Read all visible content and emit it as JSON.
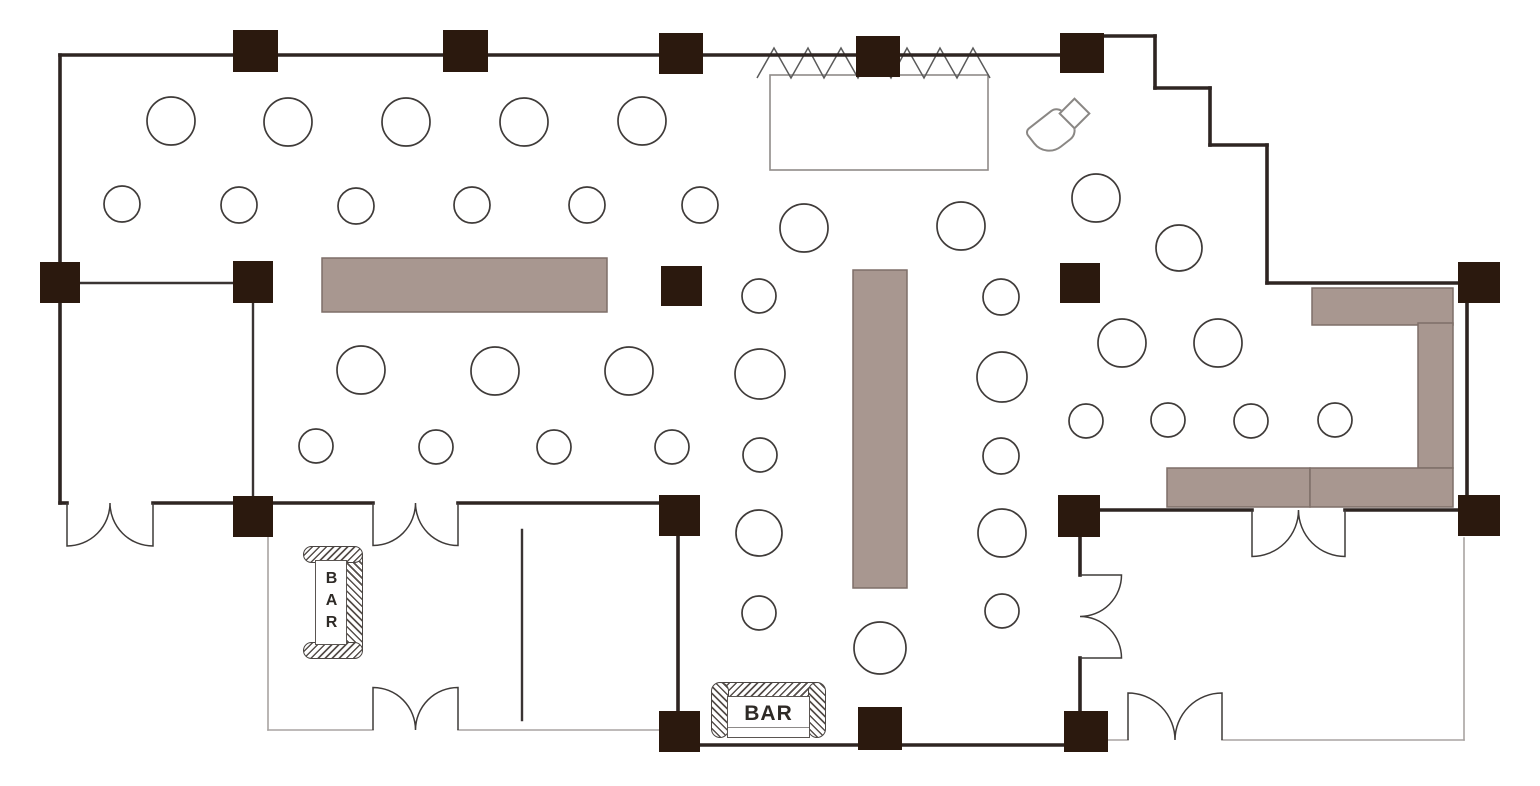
{
  "title": "Banquet hall floor plan",
  "bars": {
    "horizontal": "BAR",
    "vertical": "BAR"
  },
  "plan": {
    "width": 1540,
    "height": 786,
    "colors": {
      "wall_thick": "#2e2522",
      "wall_medium": "#3a3433",
      "wall_thin": "#a8a4a2",
      "column_fill": "#2b190e",
      "table_stroke": "#3f3b39",
      "table_fill": "#ffffff",
      "buffet_fill": "#a89790",
      "buffet_stroke": "#7e6f68",
      "stage_stroke": "#8f8b89",
      "stage_fill": "#ffffff",
      "curtain_stroke": "#5a5a5a",
      "door_stroke": "#3f3b39"
    },
    "walls_thick": [
      [
        60,
        55,
        1082,
        55
      ],
      [
        1080,
        36,
        1155,
        36
      ],
      [
        1155,
        36,
        1155,
        88
      ],
      [
        1155,
        88,
        1210,
        88
      ],
      [
        1210,
        145,
        1210,
        88
      ],
      [
        1210,
        145,
        1267,
        145
      ],
      [
        1267,
        145,
        1267,
        283
      ],
      [
        1267,
        283,
        1480,
        283
      ],
      [
        60,
        55,
        60,
        503
      ],
      [
        60,
        503,
        67,
        503
      ],
      [
        153,
        503,
        373,
        503
      ],
      [
        458,
        503,
        680,
        503
      ],
      [
        678,
        517,
        678,
        732
      ],
      [
        690,
        745,
        1087,
        745
      ],
      [
        1080,
        510,
        1252,
        510
      ],
      [
        1345,
        510,
        1480,
        510
      ],
      [
        1467,
        302,
        1467,
        498
      ],
      [
        1080,
        537,
        1080,
        575
      ],
      [
        1080,
        658,
        1080,
        712
      ]
    ],
    "walls_medium": [
      [
        80,
        283,
        233,
        283
      ],
      [
        253,
        303,
        253,
        497
      ],
      [
        522,
        530,
        522,
        720
      ]
    ],
    "walls_thin": [
      [
        268,
        537,
        268,
        730
      ],
      [
        268,
        730,
        373,
        730
      ],
      [
        458,
        730,
        660,
        730
      ],
      [
        1464,
        538,
        1464,
        740
      ],
      [
        1087,
        740,
        1128,
        740
      ],
      [
        1222,
        740,
        1464,
        740
      ]
    ],
    "columns": [
      [
        233,
        30,
        45,
        42
      ],
      [
        443,
        30,
        45,
        42
      ],
      [
        659,
        33,
        44,
        41
      ],
      [
        856,
        36,
        44,
        41
      ],
      [
        1060,
        33,
        44,
        40
      ],
      [
        40,
        262,
        40,
        41
      ],
      [
        233,
        261,
        40,
        42
      ],
      [
        661,
        266,
        41,
        40
      ],
      [
        1060,
        263,
        40,
        40
      ],
      [
        1458,
        262,
        42,
        41
      ],
      [
        233,
        496,
        40,
        41
      ],
      [
        659,
        495,
        41,
        41
      ],
      [
        1058,
        495,
        42,
        42
      ],
      [
        1458,
        495,
        42,
        41
      ],
      [
        659,
        711,
        41,
        41
      ],
      [
        858,
        707,
        44,
        43
      ],
      [
        1064,
        711,
        44,
        41
      ]
    ],
    "round_tables": [
      [
        171,
        121,
        24
      ],
      [
        288,
        122,
        24
      ],
      [
        406,
        122,
        24
      ],
      [
        524,
        122,
        24
      ],
      [
        642,
        121,
        24
      ],
      [
        122,
        204,
        18
      ],
      [
        239,
        205,
        18
      ],
      [
        356,
        206,
        18
      ],
      [
        472,
        205,
        18
      ],
      [
        587,
        205,
        18
      ],
      [
        700,
        205,
        18
      ],
      [
        361,
        370,
        24
      ],
      [
        495,
        371,
        24
      ],
      [
        629,
        371,
        24
      ],
      [
        316,
        446,
        17
      ],
      [
        436,
        447,
        17
      ],
      [
        554,
        447,
        17
      ],
      [
        672,
        447,
        17
      ],
      [
        804,
        228,
        24
      ],
      [
        961,
        226,
        24
      ],
      [
        1096,
        198,
        24
      ],
      [
        1179,
        248,
        23
      ],
      [
        759,
        296,
        17
      ],
      [
        760,
        374,
        25
      ],
      [
        760,
        455,
        17
      ],
      [
        759,
        533,
        23
      ],
      [
        759,
        613,
        17
      ],
      [
        1001,
        297,
        18
      ],
      [
        1002,
        377,
        25
      ],
      [
        1001,
        456,
        18
      ],
      [
        1002,
        533,
        24
      ],
      [
        1002,
        611,
        17
      ],
      [
        880,
        648,
        26
      ],
      [
        1122,
        343,
        24
      ],
      [
        1218,
        343,
        24
      ],
      [
        1086,
        421,
        17
      ],
      [
        1168,
        420,
        17
      ],
      [
        1251,
        421,
        17
      ],
      [
        1335,
        420,
        17
      ]
    ],
    "buffets": [
      [
        322,
        258,
        285,
        54
      ],
      [
        853,
        270,
        54,
        318
      ],
      [
        1312,
        288,
        141,
        37
      ],
      [
        1418,
        323,
        35,
        145
      ],
      [
        1167,
        468,
        143,
        39
      ],
      [
        1310,
        468,
        143,
        39
      ]
    ],
    "stage": {
      "x": 770,
      "y": 75,
      "w": 218,
      "h": 95
    },
    "curtain_points": "757,78 774,48 791,78 808,48 824,78 841,48 858,78 874,48 891,78 907,48 924,78 940,48 957,78 973,48 990,78",
    "doors": [
      {
        "x": 67,
        "y": 503,
        "span": 86,
        "dir": "down"
      },
      {
        "x": 373,
        "y": 503,
        "span": 85,
        "dir": "down"
      },
      {
        "x": 373,
        "y": 730,
        "span": 85,
        "dir": "up"
      },
      {
        "x": 1252,
        "y": 510,
        "span": 93,
        "dir": "down"
      },
      {
        "x": 1080,
        "y": 575,
        "span": 83,
        "dir": "right"
      },
      {
        "x": 1128,
        "y": 740,
        "span": 94,
        "dir": "up"
      }
    ]
  }
}
